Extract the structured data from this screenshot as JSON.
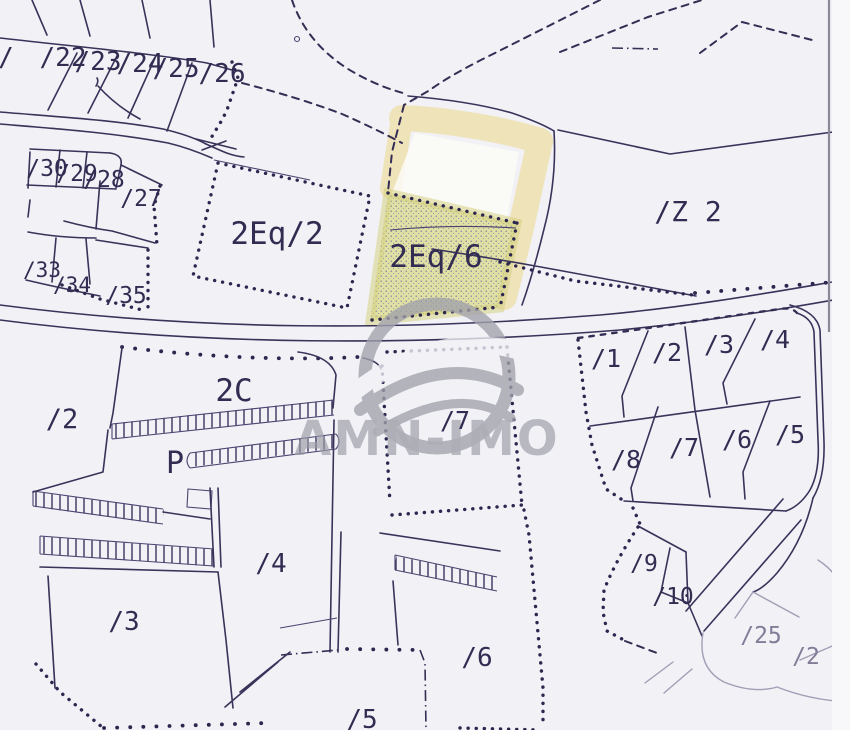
{
  "map": {
    "kind": "scanned cadastral plan",
    "watermark": {
      "text": "AMN-IMO"
    },
    "colors": {
      "paper": "#f1f1f6",
      "ink": "#39335a",
      "zone_green_fill": "#e0e0a5",
      "zone_yellow_band": "#efe3ba",
      "watermark_grey": "#a2a2ac"
    },
    "zones": [
      {
        "label": "2Eq/2",
        "style": "dotted outline"
      },
      {
        "label": "2Eq/6",
        "style": "green stipple highlight"
      },
      {
        "label": "yellow band",
        "style": "yellow highlight frame"
      }
    ]
  },
  "labels": [
    {
      "text": "/",
      "x": 6,
      "y": 66,
      "size": 26
    },
    {
      "text": "/22",
      "x": 63,
      "y": 66,
      "size": 26
    },
    {
      "text": "/23",
      "x": 98,
      "y": 70,
      "size": 26
    },
    {
      "text": "/24",
      "x": 140,
      "y": 72,
      "size": 26
    },
    {
      "text": "/25",
      "x": 176,
      "y": 77,
      "size": 26
    },
    {
      "text": "/26",
      "x": 222,
      "y": 82,
      "size": 26
    },
    {
      "text": "/30",
      "x": 47,
      "y": 176,
      "size": 23
    },
    {
      "text": "/29",
      "x": 77,
      "y": 181,
      "size": 23
    },
    {
      "text": "/28",
      "x": 104,
      "y": 187,
      "size": 23
    },
    {
      "text": "/27",
      "x": 141,
      "y": 206,
      "size": 23
    },
    {
      "text": "/33",
      "x": 42,
      "y": 277,
      "size": 21
    },
    {
      "text": "/34",
      "x": 72,
      "y": 292,
      "size": 21
    },
    {
      "text": "/35",
      "x": 126,
      "y": 303,
      "size": 23
    },
    {
      "text": "2Eq/2",
      "x": 277,
      "y": 244,
      "size": 31
    },
    {
      "text": "2Eq/6",
      "x": 436,
      "y": 267,
      "size": 31
    },
    {
      "text": "/Z 2",
      "x": 688,
      "y": 221,
      "size": 28
    },
    {
      "text": "2C",
      "x": 234,
      "y": 401,
      "size": 31
    },
    {
      "text": "/2",
      "x": 62,
      "y": 428,
      "size": 27
    },
    {
      "text": "P",
      "x": 175,
      "y": 473,
      "size": 30
    },
    {
      "text": "/7",
      "x": 455,
      "y": 429,
      "size": 25
    },
    {
      "text": "/1",
      "x": 606,
      "y": 367,
      "size": 25
    },
    {
      "text": "/2",
      "x": 667,
      "y": 361,
      "size": 25
    },
    {
      "text": "/3",
      "x": 719,
      "y": 353,
      "size": 25
    },
    {
      "text": "/4",
      "x": 775,
      "y": 348,
      "size": 25
    },
    {
      "text": "/8",
      "x": 626,
      "y": 468,
      "size": 25
    },
    {
      "text": "/7",
      "x": 684,
      "y": 456,
      "size": 25
    },
    {
      "text": "/6",
      "x": 737,
      "y": 448,
      "size": 25
    },
    {
      "text": "/5",
      "x": 790,
      "y": 443,
      "size": 25
    },
    {
      "text": "/9",
      "x": 644,
      "y": 571,
      "size": 23
    },
    {
      "text": "/10",
      "x": 673,
      "y": 604,
      "size": 23
    },
    {
      "text": "/25",
      "x": 761,
      "y": 643,
      "size": 23,
      "light": true
    },
    {
      "text": "/2",
      "x": 806,
      "y": 664,
      "size": 23,
      "light": true
    },
    {
      "text": "/4",
      "x": 271,
      "y": 572,
      "size": 26
    },
    {
      "text": "/3",
      "x": 124,
      "y": 630,
      "size": 26
    },
    {
      "text": "/6",
      "x": 477,
      "y": 666,
      "size": 26
    },
    {
      "text": "/5",
      "x": 362,
      "y": 728,
      "size": 26
    }
  ]
}
